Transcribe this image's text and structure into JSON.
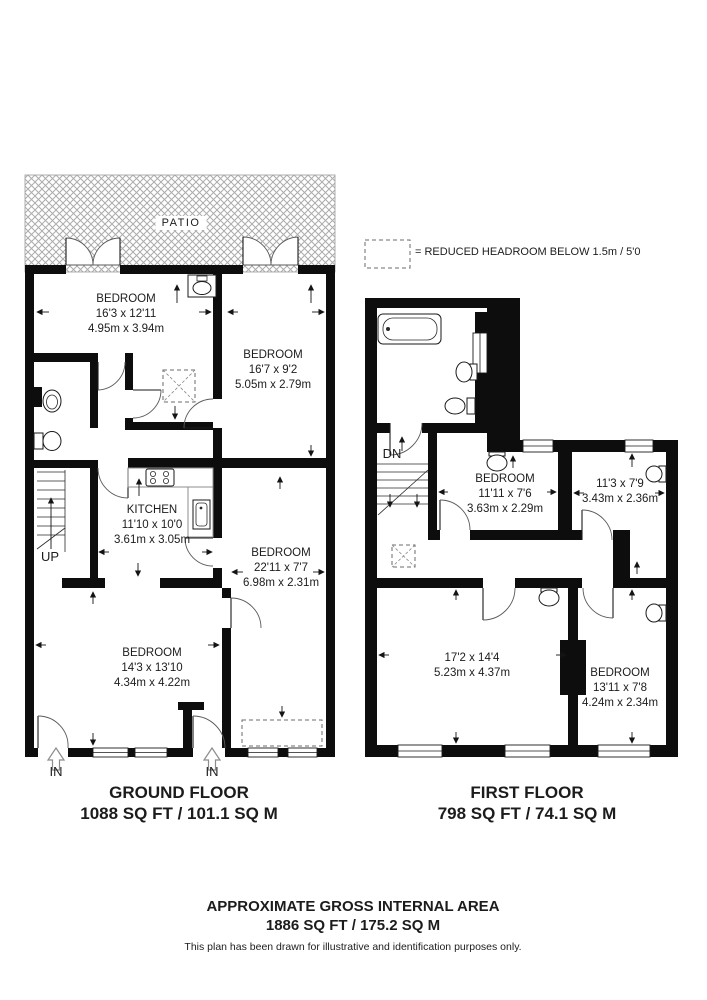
{
  "legend": {
    "symbol": "reduced-headroom-dashed-box",
    "text": "= REDUCED HEADROOM BELOW 1.5m / 5'0"
  },
  "ground_floor": {
    "title": "GROUND FLOOR",
    "area": "1088 SQ FT / 101.1 SQ M",
    "patio_label": "PATIO",
    "stairs_label": "UP",
    "entrance_labels": [
      "IN",
      "IN"
    ],
    "rooms": [
      {
        "name": "BEDROOM",
        "imperial": "16'3 x 12'11",
        "metric": "4.95m x 3.94m"
      },
      {
        "name": "BEDROOM",
        "imperial": "16'7 x 9'2",
        "metric": "5.05m x 2.79m"
      },
      {
        "name": "KITCHEN",
        "imperial": "11'10 x 10'0",
        "metric": "3.61m x 3.05m"
      },
      {
        "name": "BEDROOM",
        "imperial": "22'11 x 7'7",
        "metric": "6.98m x 2.31m"
      },
      {
        "name": "BEDROOM",
        "imperial": "14'3 x 13'10",
        "metric": "4.34m x 4.22m"
      }
    ]
  },
  "first_floor": {
    "title": "FIRST FLOOR",
    "area": "798 SQ FT / 74.1 SQ M",
    "stairs_label": "DN",
    "rooms": [
      {
        "name": "BEDROOM",
        "imperial": "11'11 x 7'6",
        "metric": "3.63m x 2.29m"
      },
      {
        "name": "",
        "imperial": "11'3 x 7'9",
        "metric": "3.43m x 2.36m"
      },
      {
        "name": "",
        "imperial": "17'2 x 14'4",
        "metric": "5.23m x 4.37m"
      },
      {
        "name": "BEDROOM",
        "imperial": "13'11 x 7'8",
        "metric": "4.24m x 2.34m"
      }
    ]
  },
  "footer": {
    "title": "APPROXIMATE GROSS INTERNAL AREA",
    "area": "1886 SQ FT / 175.2 SQ M",
    "disclaimer": "This plan has been drawn for illustrative and identification purposes only."
  },
  "colors": {
    "wall": "#0d0d0d",
    "patio_hatch": "#ababab",
    "text": "#1c1c1c",
    "background": "#ffffff"
  }
}
